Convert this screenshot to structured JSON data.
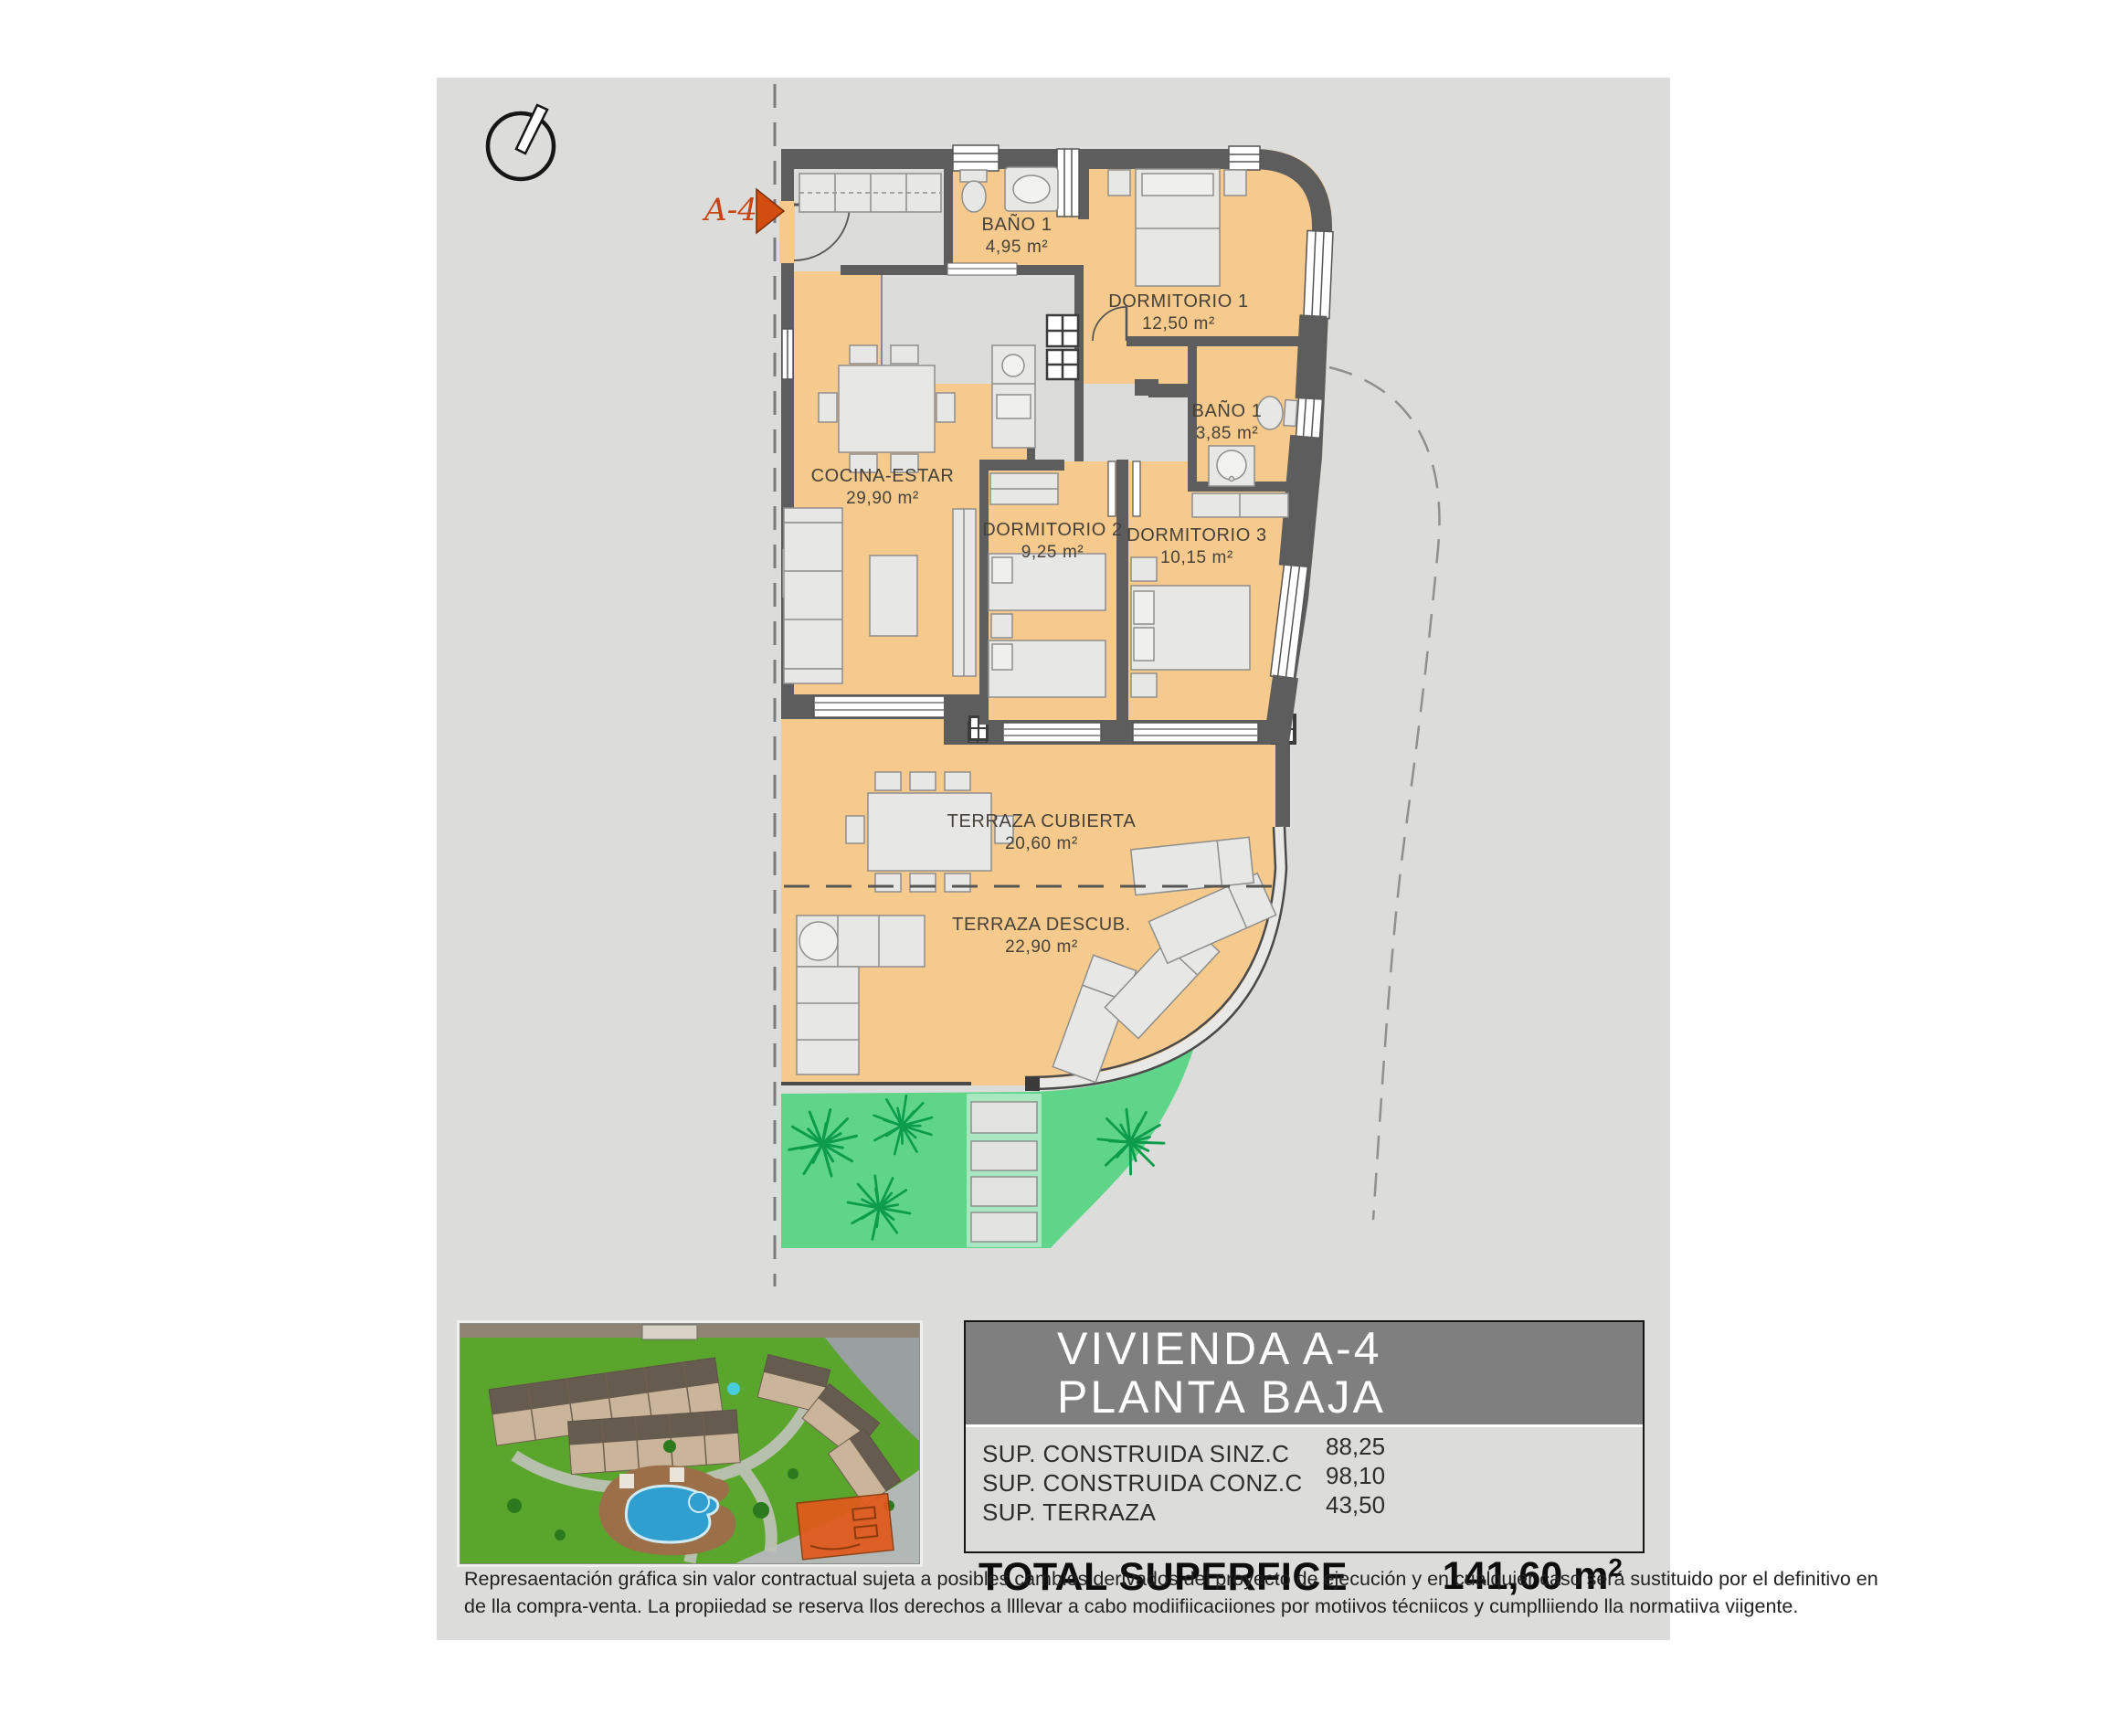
{
  "plan": {
    "unit_marker": "A-4",
    "rooms": [
      {
        "name": "BAÑO 1",
        "area": "4,95 m²"
      },
      {
        "name": "DORMITORIO 1",
        "area": "12,50 m²"
      },
      {
        "name": "BAÑO 1",
        "area": "3,85 m²"
      },
      {
        "name": "COCINA-ESTAR",
        "area": "29,90 m²"
      },
      {
        "name": "DORMITORIO 2",
        "area": "9,25 m²"
      },
      {
        "name": "DORMITORIO 3",
        "area": "10,15 m²"
      },
      {
        "name": "TERRAZA CUBIERTA",
        "area": "20,60 m²"
      },
      {
        "name": "TERRAZA DESCUB.",
        "area": "22,90 m²"
      }
    ]
  },
  "title_block": {
    "line1": "VIVIENDA A-4",
    "line2": "PLANTA BAJA",
    "rows": [
      {
        "label": "SUP. CONSTRUIDA SINZ.C",
        "value": "88,25"
      },
      {
        "label": "SUP. CONSTRUIDA CONZ.C",
        "value": "98,10"
      },
      {
        "label": "SUP. TERRAZA",
        "value": "43,50"
      }
    ],
    "total_label": "TOTAL SUPERFICE",
    "total_value": "141,60 m",
    "total_sup": "2"
  },
  "disclaimer": {
    "line1": "Represaentación gráfica sin valor contractual sujeta a posibles cambios derivados del proyecto de ejecución y en cualquier caso será sustituido por el definitivo en",
    "line2": "de lla compra-venta. La propiiedad se reserva llos derechos a llllevar a cabo modiifiicaciiones por motiivos técniicos y cumplliiendo lla normatiiva viigente."
  },
  "colors": {
    "floor_orange": "#f6ca8c",
    "wall_gray": "#5d5d5d",
    "garden_green": "#5fd58a",
    "accent_red": "#d44d10",
    "header_gray": "#7f7f7f",
    "canvas_gray": "#dcdcda"
  }
}
